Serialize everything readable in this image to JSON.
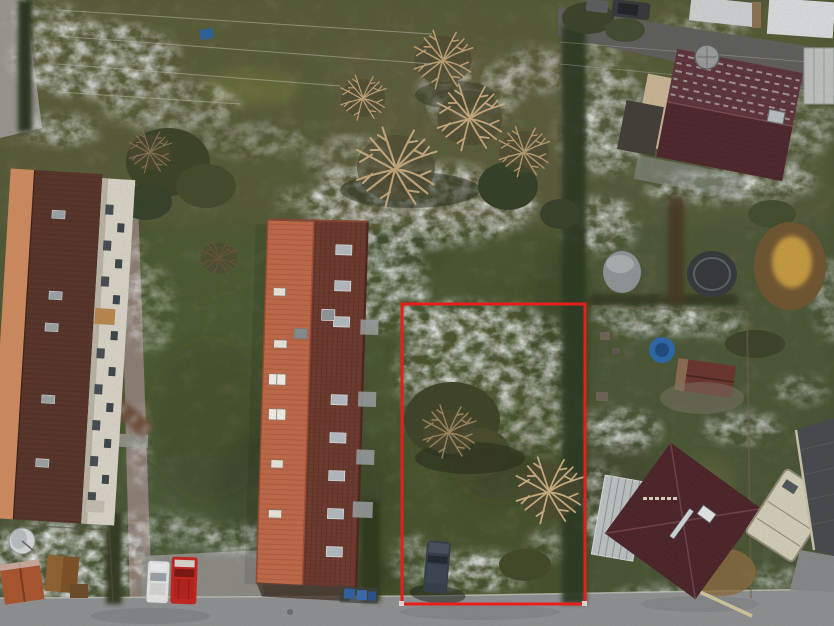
{
  "scene": {
    "type": "aerial-drone-photo",
    "season": "winter",
    "description": "Top-down winter drone photo of a residential neighborhood with patchy snow on grass. A red rectangle annotation outlines a vacant grass plot between a long brick apartment block (left) and detached family houses with dark burgundy roofs (right). A street runs along the bottom with a red van and a white car parked on a pad; bare winter trees, hedges, garden sheds, a pond, a rain barrel and a caravan fill the gardens.",
    "annotation": {
      "type": "plot-boundary-rectangle",
      "color": "#ee1b19",
      "x": 402,
      "y": 304,
      "width": 183,
      "height": 300
    },
    "colors": {
      "grass_green": "#4a5531",
      "snow_white": "#e9edf0",
      "brick_roof_orange": "#c06848",
      "brick_roof_dark": "#6d392e",
      "maroon_roof": "#573329",
      "facade_white": "#d8d3c6",
      "salmon_wall": "#cf8a5f",
      "house_roof_upper": "#5d343c",
      "house_roof_lower": "#4e262e",
      "hip_roof": "#4c232a",
      "conservatory": "#bcc1c3",
      "caravan": "#d3cdb8",
      "shed_red": "#6a332e",
      "small_shed_orange": "#a8542e",
      "car_red": "#c32420",
      "car_white": "#e4e5e2",
      "van_dark": "#333d4a",
      "car_black": "#34383c",
      "pool_blue": "#2a67a8",
      "pond": "#6f5430",
      "pond_center": "#c49a3f",
      "barrel": "#8e9498",
      "tub_dark": "#34383b",
      "street": "#8e9092",
      "driveway": "#5f5e5b",
      "path": "#8f8078",
      "hedge_dark": "#2d3a23",
      "hedge_brown": "#6e4f3b",
      "tree_branch_tan": "#c9ab80",
      "bin_blue": "#2f5fa0"
    },
    "objects": [
      "vacant-plot-boundary",
      "long-apartment-building",
      "white-apartment-building",
      "detached-house-north",
      "detached-house-south",
      "conservatory",
      "caravan",
      "garden-sheds",
      "red-van",
      "white-car",
      "dark-van-on-plot",
      "parked-car-north",
      "street",
      "driveway",
      "footpath",
      "parking-pad",
      "snow-patches",
      "bare-trees",
      "hedges",
      "garden-pond",
      "rain-barrel",
      "hot-tub",
      "blue-paddling-pool",
      "satellite-dish",
      "trampoline",
      "recycling-bins",
      "clotheslines"
    ]
  }
}
